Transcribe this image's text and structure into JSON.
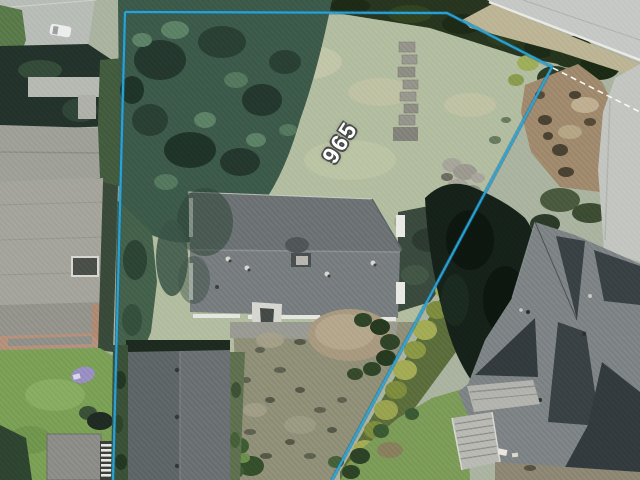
{
  "map": {
    "parcel": {
      "label": "965",
      "line_color": "#2ba4d6",
      "line_casing_color": "#17648c",
      "label_color": "#ffffff",
      "label_outline_color": "#4a4a4a"
    },
    "adjacent_line": {
      "color": "#fdfdfb",
      "style": "dashed"
    }
  }
}
